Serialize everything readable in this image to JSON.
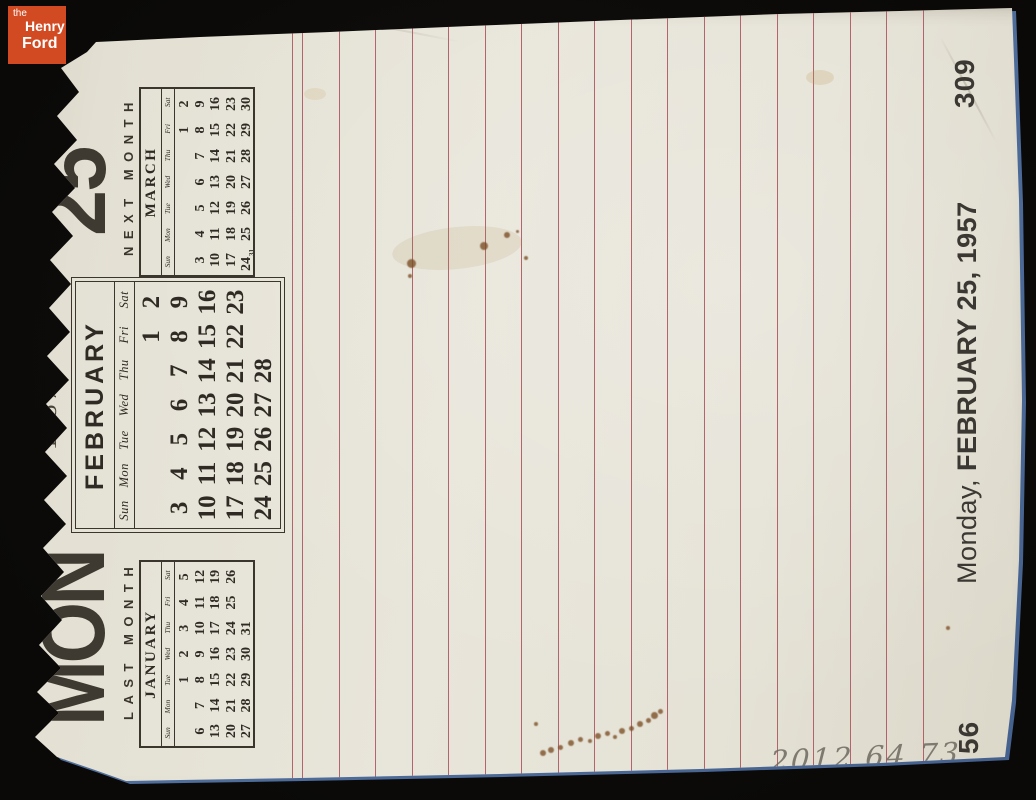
{
  "logo": {
    "line1": "the",
    "line2": "Henry",
    "line3": "Ford"
  },
  "calendar_page": {
    "day_abbreviation": "MON",
    "day_number": "25",
    "year": "1957",
    "last_month_label": "LAST MONTH",
    "next_month_label": "NEXT MONTH",
    "months": [
      {
        "title": "JANUARY",
        "dow": [
          "Sun",
          "Mon",
          "Tue",
          "Wed",
          "Thu",
          "Fri",
          "Sat"
        ],
        "weeks": [
          [
            "",
            "",
            "1",
            "2",
            "3",
            "4",
            "5"
          ],
          [
            "6",
            "7",
            "8",
            "9",
            "10",
            "11",
            "12"
          ],
          [
            "13",
            "14",
            "15",
            "16",
            "17",
            "18",
            "19"
          ],
          [
            "20",
            "21",
            "22",
            "23",
            "24",
            "25",
            "26"
          ],
          [
            "27",
            "28",
            "29",
            "30",
            "31",
            "",
            ""
          ]
        ]
      },
      {
        "title": "FEBRUARY",
        "dow": [
          "Sun",
          "Mon",
          "Tue",
          "Wed",
          "Thu",
          "Fri",
          "Sat"
        ],
        "weeks": [
          [
            "",
            "",
            "",
            "",
            "",
            "1",
            "2"
          ],
          [
            "3",
            "4",
            "5",
            "6",
            "7",
            "8",
            "9"
          ],
          [
            "10",
            "11",
            "12",
            "13",
            "14",
            "15",
            "16"
          ],
          [
            "17",
            "18",
            "19",
            "20",
            "21",
            "22",
            "23"
          ],
          [
            "24",
            "25",
            "26",
            "27",
            "28",
            "",
            ""
          ]
        ]
      },
      {
        "title": "MARCH",
        "dow": [
          "Sun",
          "Mon",
          "Tue",
          "Wed",
          "Thu",
          "Fri",
          "Sat"
        ],
        "weeks": [
          [
            "",
            "",
            "",
            "",
            "",
            "1",
            "2"
          ],
          [
            "3",
            "4",
            "5",
            "6",
            "7",
            "8",
            "9"
          ],
          [
            "10",
            "11",
            "12",
            "13",
            "14",
            "15",
            "16"
          ],
          [
            "17",
            "18",
            "19",
            "20",
            "21",
            "22",
            "23"
          ],
          [
            "24/31",
            "25",
            "26",
            "27",
            "28",
            "29",
            "30"
          ]
        ]
      }
    ],
    "footer_caption": {
      "weekday": "Monday,",
      "date": "FEBRUARY 25, 1957"
    },
    "page_numbers": {
      "top": "309",
      "bottom": "56"
    }
  },
  "annotations": {
    "accession_number": "2012.64.73"
  },
  "colors": {
    "background": "#0d0c0a",
    "paper": "#e5e2d6",
    "ruling": "#a84f58",
    "print_ink": "#35302a",
    "pencil": "#6e695e",
    "logo_background": "#d14a22",
    "photo_edge_fringe": "#5b7cab"
  }
}
